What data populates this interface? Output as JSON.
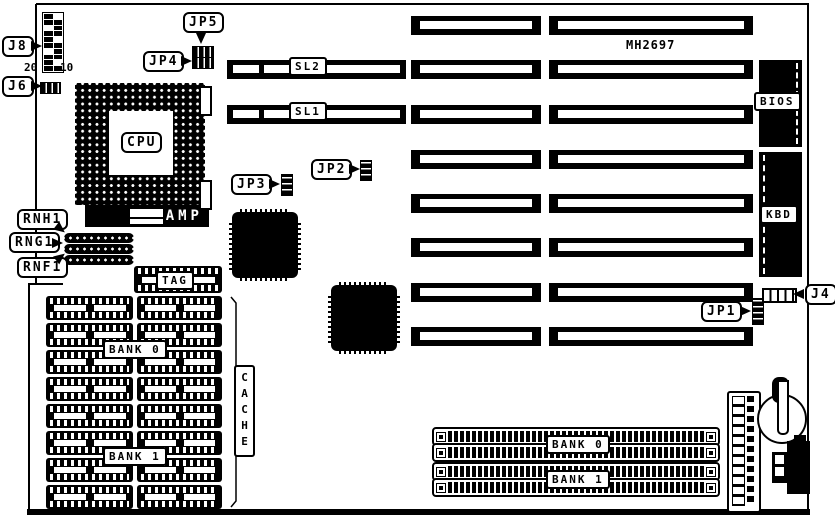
{
  "colors": {
    "ink": "#000000",
    "paper": "#ffffff"
  },
  "board_model": "MH2697",
  "connectors": {
    "j8": "J8",
    "j6": "J6",
    "j4": "J4"
  },
  "jumpers": {
    "jp1": "JP1",
    "jp2": "JP2",
    "jp3": "JP3",
    "jp4": "JP4",
    "jp5": "JP5"
  },
  "cpu": {
    "label": "CPU",
    "amp": "AMP"
  },
  "resistor_networks": {
    "rnh1": "RNH1",
    "rng1": "RNG1",
    "rnf1": "RNF1"
  },
  "cache": {
    "label": "CACHE",
    "tag": "TAG",
    "bank0": "BANK 0",
    "bank1": "BANK 1",
    "chips_per_bank": 8
  },
  "memory": {
    "bank0": "BANK 0",
    "bank1": "BANK 1",
    "socket_count": 4
  },
  "slots": {
    "sl1": "SL1",
    "sl2": "SL2",
    "rows": 8,
    "columns": 2
  },
  "chips": {
    "bios": "BIOS",
    "kbd": "KBD"
  },
  "pin_labels": {
    "j8_left": "20",
    "j8_right": "10"
  }
}
